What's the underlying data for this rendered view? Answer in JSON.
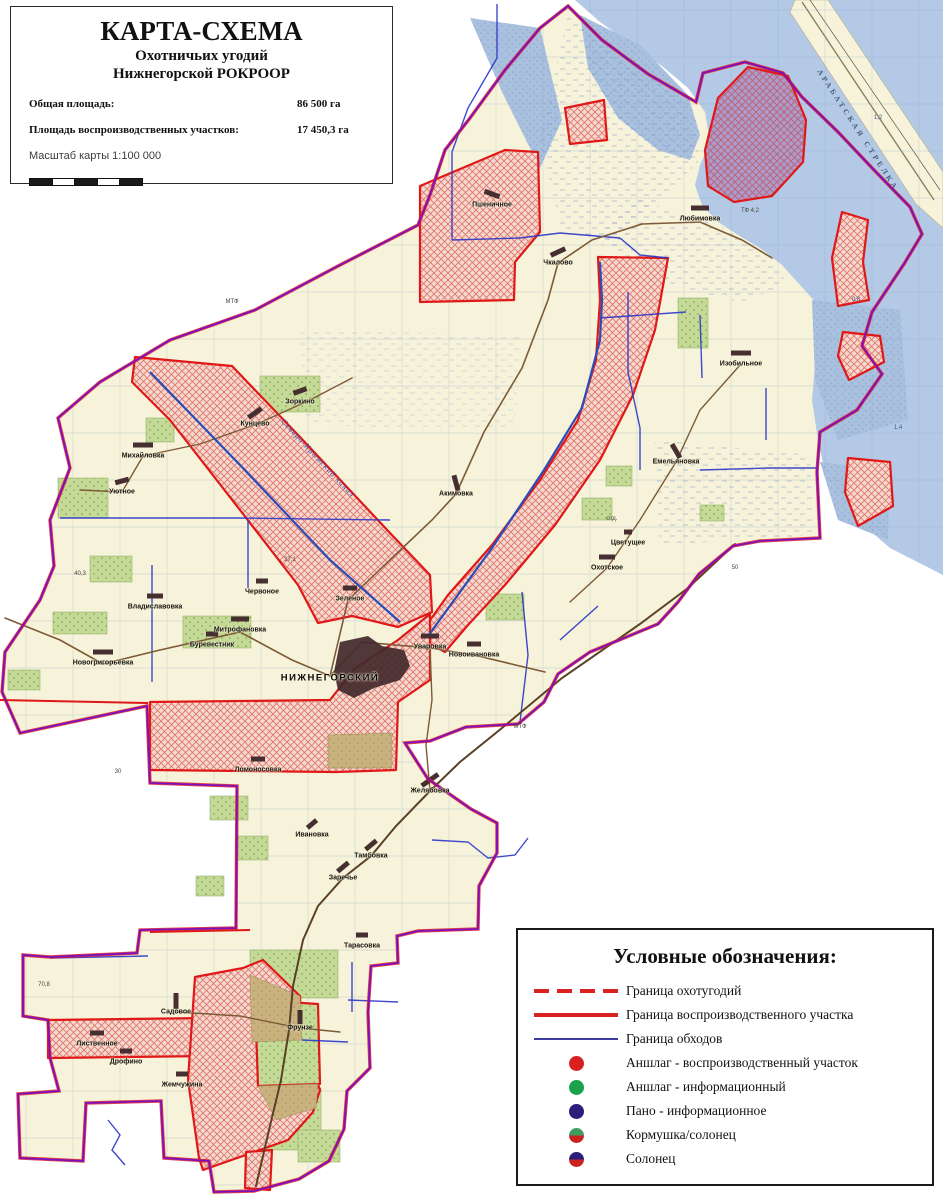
{
  "title_box": {
    "title": "КАРТА-СХЕМА",
    "subtitle_line1": "Охотничьих угодий",
    "subtitle_line2": "Нижнегорской РОКРООР",
    "stats": [
      {
        "label": "Общая площадь:",
        "value": "86 500 га"
      },
      {
        "label": "Площадь воспроизводственных участков:",
        "value": "17 450,3 га"
      }
    ],
    "scale_label": "Масштаб карты 1:100 000"
  },
  "legend": {
    "title": "Условные обозначения:",
    "items": [
      {
        "symbol": "line-dashed",
        "color": "#d92121",
        "label": "Граница охотугодий"
      },
      {
        "symbol": "line-solid",
        "color": "#d92121",
        "label": "Граница воспроизводственного участка"
      },
      {
        "symbol": "line-thin",
        "color": "#3d3da0",
        "label": "Граница обходов"
      },
      {
        "symbol": "circle",
        "color": "#d92121",
        "label": "Аншлаг - воспроизводственный участок"
      },
      {
        "symbol": "circle",
        "color": "#18a24c",
        "label": "Аншлаг - информационный"
      },
      {
        "symbol": "circle",
        "color": "#2a1f7a",
        "label": "Пано - информационное"
      },
      {
        "symbol": "circle-split",
        "color_top": "#3f9e5f",
        "color_bottom": "#cc2222",
        "label": "Кормушка/солонец"
      },
      {
        "symbol": "circle-split",
        "color_top": "#2a1f7a",
        "color_bottom": "#cc2222",
        "label": "Солонец"
      }
    ]
  },
  "map": {
    "colors": {
      "boundary": "#7c10c0",
      "reproduction_border": "#e01818",
      "patrol_line": "#2a35c8",
      "water": "#b3c9e6",
      "land": "#f6f3da",
      "forest_green": "#c5da96",
      "road_brown": "#7d5a36"
    },
    "settlements": [
      {
        "name": "Пшеничное",
        "x": 492,
        "y": 205,
        "angle": 20,
        "len": 16
      },
      {
        "name": "Чкалово",
        "x": 558,
        "y": 263,
        "angle": -25,
        "len": 16
      },
      {
        "name": "Любимовка",
        "x": 700,
        "y": 219,
        "angle": 0,
        "len": 18
      },
      {
        "name": "Изобильное",
        "x": 741,
        "y": 364,
        "angle": 0,
        "len": 20
      },
      {
        "name": "Емельяновка",
        "x": 676,
        "y": 462,
        "angle": 60,
        "len": 16
      },
      {
        "name": "Охотское",
        "x": 607,
        "y": 568,
        "angle": 0,
        "len": 16
      },
      {
        "name": "Цветущее",
        "x": 628,
        "y": 543,
        "angle": 0,
        "len": 8
      },
      {
        "name": "Акимовка",
        "x": 456,
        "y": 494,
        "angle": 75,
        "len": 16
      },
      {
        "name": "Зоркино",
        "x": 300,
        "y": 402,
        "angle": -20,
        "len": 14
      },
      {
        "name": "Кунцево",
        "x": 255,
        "y": 424,
        "angle": -35,
        "len": 16
      },
      {
        "name": "Михайловка",
        "x": 143,
        "y": 456,
        "angle": 0,
        "len": 20
      },
      {
        "name": "Уютное",
        "x": 122,
        "y": 492,
        "angle": -15,
        "len": 14
      },
      {
        "name": "Владиславовка",
        "x": 155,
        "y": 607,
        "angle": 0,
        "len": 16
      },
      {
        "name": "Новогригорьевка",
        "x": 103,
        "y": 663,
        "angle": 0,
        "len": 20
      },
      {
        "name": "Буревестник",
        "x": 212,
        "y": 645,
        "angle": 0,
        "len": 12
      },
      {
        "name": "Червоное",
        "x": 262,
        "y": 592,
        "angle": 0,
        "len": 12
      },
      {
        "name": "Митрофановка",
        "x": 240,
        "y": 630,
        "angle": 0,
        "len": 18
      },
      {
        "name": "Зеленое",
        "x": 350,
        "y": 599,
        "angle": 0,
        "len": 14
      },
      {
        "name": "НИЖНЕГОРСКИЙ",
        "x": 330,
        "y": 678,
        "angle": 0,
        "len": 0,
        "big": true
      },
      {
        "name": "Уваровка",
        "x": 430,
        "y": 647,
        "angle": 0,
        "len": 18
      },
      {
        "name": "Новоивановка",
        "x": 474,
        "y": 655,
        "angle": 0,
        "len": 14
      },
      {
        "name": "Ломоносовка",
        "x": 258,
        "y": 770,
        "angle": 0,
        "len": 14
      },
      {
        "name": "Желябовка",
        "x": 430,
        "y": 791,
        "angle": -35,
        "len": 20
      },
      {
        "name": "Ивановка",
        "x": 312,
        "y": 835,
        "angle": -40,
        "len": 12
      },
      {
        "name": "Тамбовка",
        "x": 371,
        "y": 856,
        "angle": -40,
        "len": 14
      },
      {
        "name": "Заречье",
        "x": 343,
        "y": 878,
        "angle": -40,
        "len": 14
      },
      {
        "name": "Тарасовка",
        "x": 362,
        "y": 946,
        "angle": 0,
        "len": 12
      },
      {
        "name": "Садовое",
        "x": 176,
        "y": 1012,
        "angle": 90,
        "len": 16
      },
      {
        "name": "Фрунзе",
        "x": 300,
        "y": 1028,
        "angle": 90,
        "len": 14
      },
      {
        "name": "Лиственное",
        "x": 97,
        "y": 1044,
        "angle": 0,
        "len": 14
      },
      {
        "name": "Дрофино",
        "x": 126,
        "y": 1062,
        "angle": 0,
        "len": 12
      },
      {
        "name": "Жемчужина",
        "x": 182,
        "y": 1085,
        "angle": 0,
        "len": 12
      }
    ],
    "rotated_labels": [
      {
        "text": "Северо-Крымский канал",
        "x": 318,
        "y": 458,
        "angle": 47,
        "kind": "canal"
      },
      {
        "text": "АРАБАТСКАЯ СТРЕЛКА",
        "x": 858,
        "y": 130,
        "angle": 57,
        "kind": "spit"
      }
    ],
    "micro_labels": [
      {
        "text": "ТФ 4,2",
        "x": 750,
        "y": 211,
        "water": false
      },
      {
        "text": "МТФ",
        "x": 232,
        "y": 302,
        "water": false
      },
      {
        "text": "МТФ",
        "x": 520,
        "y": 727,
        "water": false
      },
      {
        "text": "отд.",
        "x": 612,
        "y": 519,
        "water": false
      },
      {
        "text": "40,3",
        "x": 80,
        "y": 574,
        "water": false
      },
      {
        "text": "50",
        "x": 735,
        "y": 568,
        "water": false
      },
      {
        "text": "27,1",
        "x": 290,
        "y": 560,
        "water": false
      },
      {
        "text": "30",
        "x": 118,
        "y": 772,
        "water": false
      },
      {
        "text": "70,8",
        "x": 44,
        "y": 985,
        "water": false
      },
      {
        "text": "1,2",
        "x": 878,
        "y": 118,
        "water": true
      },
      {
        "text": "0,8",
        "x": 856,
        "y": 300,
        "water": true
      },
      {
        "text": "1,4",
        "x": 898,
        "y": 428,
        "water": true
      }
    ]
  }
}
